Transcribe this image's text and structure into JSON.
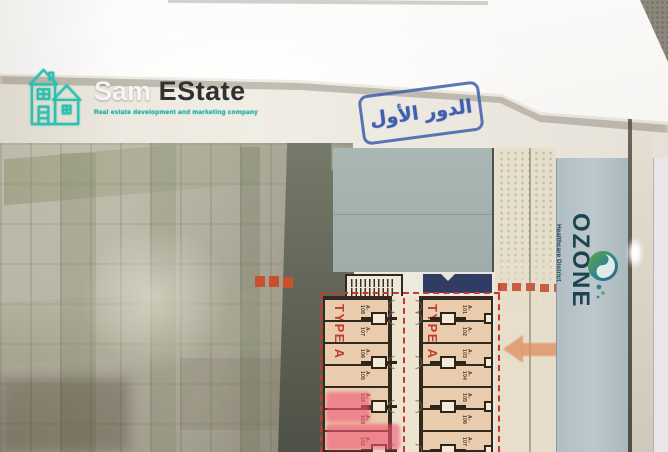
{
  "watermark": {
    "brand_first": "Sam",
    "brand_second": "EState",
    "tagline": "Real estate development and marketing company"
  },
  "stamp": {
    "text": "الدور الأول"
  },
  "titleblock": {
    "name": "OZONE",
    "subtitle": "Healthcare District"
  },
  "plan": {
    "type_label": "TYPE A",
    "left_column_units": [
      "A-108",
      "A-107",
      "A-106",
      "A-105",
      "A-104",
      "A-103",
      "A-102"
    ],
    "right_column_units": [
      "A-101",
      "A-102",
      "A-103",
      "A-104",
      "A-105",
      "A-106",
      "A-107"
    ],
    "highlighted_units": [
      "A-103",
      "A-102"
    ]
  },
  "icons": {
    "brand": "house-icon",
    "titleblock": "swirl-circle-icon",
    "plan_arrow": "left-arrow-icon"
  },
  "colors": {
    "brand_accent": "#2ec4b6",
    "stamp_blue": "#3d5fae",
    "type_red": "#c23b2e",
    "highlight_pink": "#f05a78",
    "band_blue": "#b7c4c9",
    "ozone_text": "#1c4350",
    "unit_fill": "#e9cbad",
    "navy_block": "#303c63"
  }
}
